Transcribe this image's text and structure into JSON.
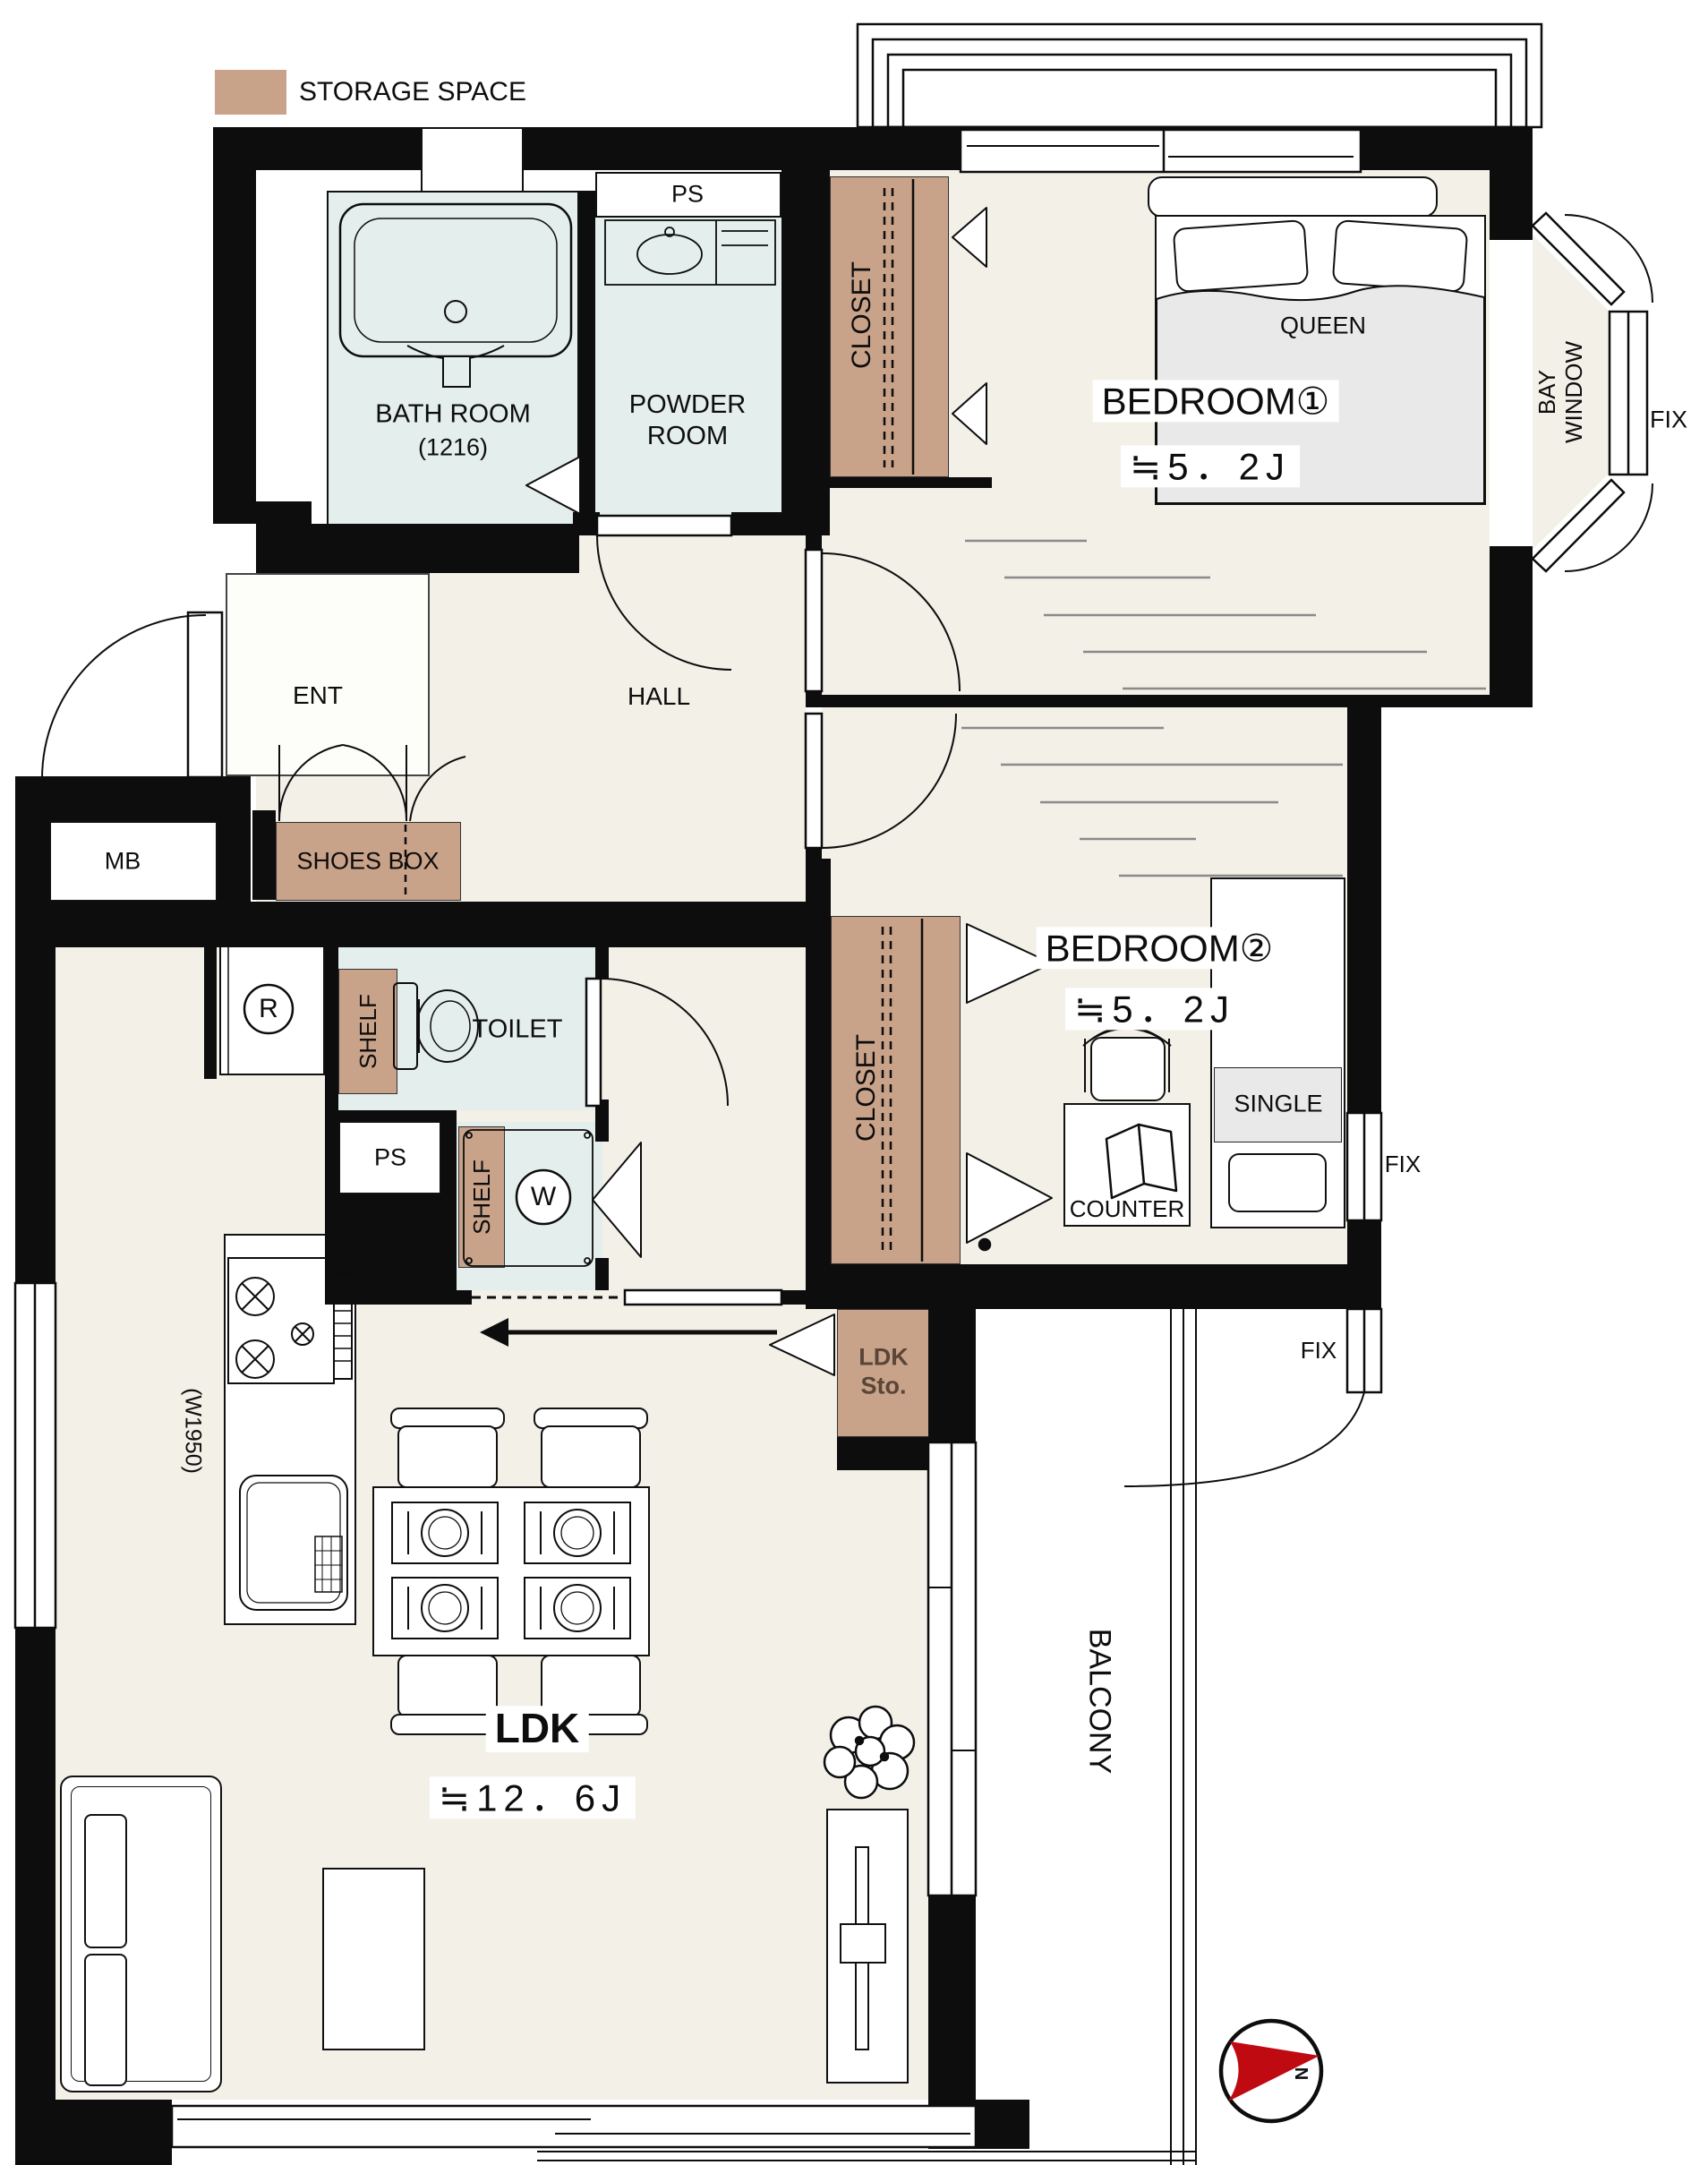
{
  "legend": {
    "label": "STORAGE SPACE",
    "swatch_color": "#c9a28a"
  },
  "rooms": {
    "bathroom": {
      "name": "BATH ROOM",
      "size": "(1216)"
    },
    "powder_room": {
      "name": "POWDER ROOM"
    },
    "toilet": {
      "name": "TOILET"
    },
    "entrance": {
      "name": "ENT"
    },
    "hall": {
      "name": "HALL"
    },
    "ldk": {
      "name": "LDK",
      "size": "≒12．6J",
      "kitchen_width": "(W1950)"
    },
    "bedroom1": {
      "name": "BEDROOM①",
      "size": "≒5．2J",
      "bed": "QUEEN"
    },
    "bedroom2": {
      "name": "BEDROOM②",
      "size": "≒5．2J",
      "bed": "SINGLE",
      "desk": "COUNTER"
    },
    "balcony": {
      "name": "BALCONY"
    },
    "bay_window": {
      "name": "BAY WINDOW"
    }
  },
  "storage": {
    "closet1": "CLOSET",
    "closet2": "CLOSET",
    "shoes_box": "SHOES BOX",
    "shelf_toilet": "SHELF",
    "shelf_washer": "SHELF",
    "ldk_storage": {
      "line1": "LDK",
      "line2": "Sto."
    }
  },
  "fixtures": {
    "ps_upper": "PS",
    "ps_kitchen": "PS",
    "meter_box": "MB",
    "washer": "W",
    "refrigerator": "R"
  },
  "windows": {
    "fix_bay": "FIX",
    "fix_bedroom2_side": "FIX",
    "fix_bedroom2_bottom": "FIX"
  },
  "compass": {
    "north": "N"
  }
}
